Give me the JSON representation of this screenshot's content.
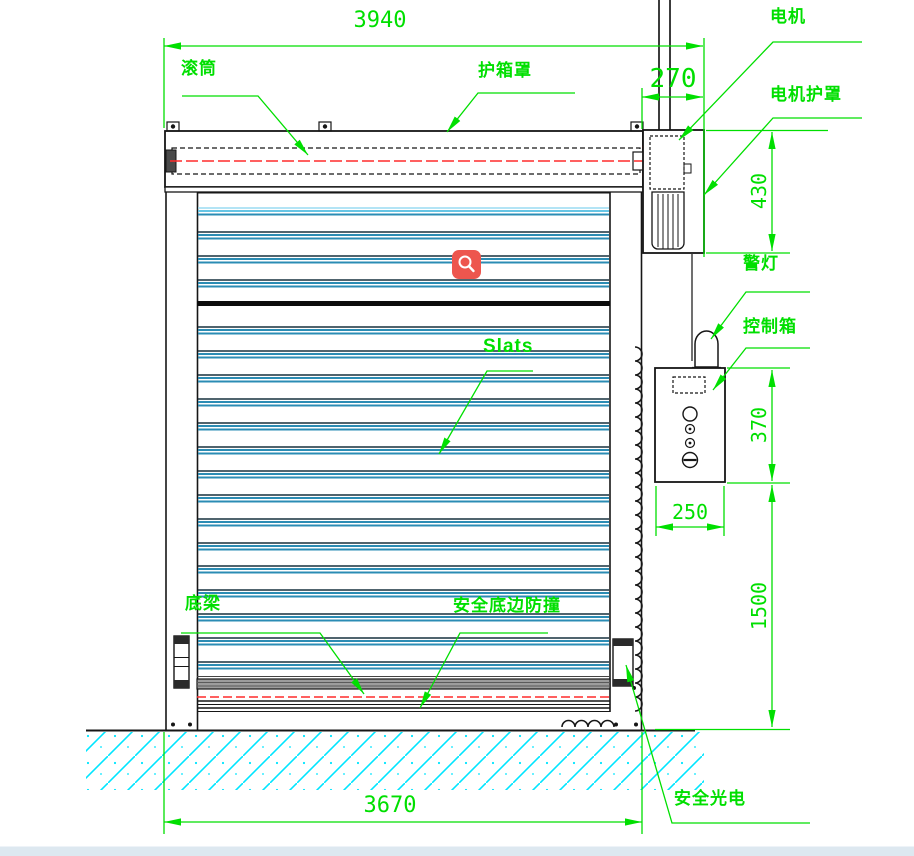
{
  "drawing": {
    "type": "engineering-diagram-roller-shutter-door",
    "labels": {
      "roller": "滚筒",
      "hood": "护箱罩",
      "motor": "电机",
      "motor_cover": "电机护罩",
      "warning_light": "警灯",
      "control_box": "控制箱",
      "slats": "Slats",
      "bottom_beam": "底梁",
      "safety_edge": "安全底边防撞",
      "safety_photocell": "安全光电"
    },
    "dimensions": {
      "total_width": "3940",
      "motor_side_width": "270",
      "motor_cover_height": "430",
      "control_box_height": "370",
      "control_box_width": "250",
      "control_box_floor_height": "1500",
      "opening_width": "3670"
    },
    "colors": {
      "annotation_green": "#00df00",
      "slat_blue": "#2b8cb4",
      "slat_dark": "#16303f",
      "hatch_cyan": "#00e5ff",
      "centerline_red": "#ff2b2b",
      "marker_red": "#ed564e"
    },
    "marker_icon": "magnifier"
  }
}
